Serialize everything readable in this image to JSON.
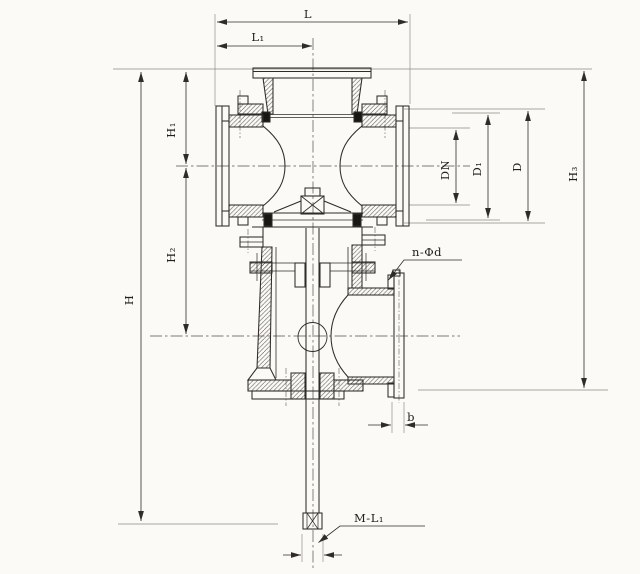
{
  "drawing": {
    "type": "valve-cross-section-technical-drawing",
    "background_color": "#fbfaf7",
    "line_color": "#2f2c28",
    "thin_line_color": "#6a675f",
    "labels": {
      "L": {
        "text": "L",
        "role": "overall-length-dimension"
      },
      "L1": {
        "text": "L₁",
        "role": "half-length-dimension"
      },
      "H1": {
        "text": "H₁",
        "role": "upper-height-dimension"
      },
      "H2": {
        "text": "H₂",
        "role": "middle-height-dimension"
      },
      "H": {
        "text": "H",
        "role": "overall-height-dimension"
      },
      "DN": {
        "text": "DN",
        "role": "nominal-bore-diameter"
      },
      "D1": {
        "text": "D₁",
        "role": "bolt-circle-diameter"
      },
      "D": {
        "text": "D",
        "role": "flange-outer-diameter"
      },
      "H3": {
        "text": "H₃",
        "role": "outlet-height-dimension"
      },
      "nphid": {
        "text": "n-Φd",
        "role": "bolt-holes-callout"
      },
      "b": {
        "text": "b",
        "role": "flange-thickness-dimension"
      },
      "ML1": {
        "text": "M-L₁",
        "role": "stem-thread-callout"
      }
    }
  }
}
